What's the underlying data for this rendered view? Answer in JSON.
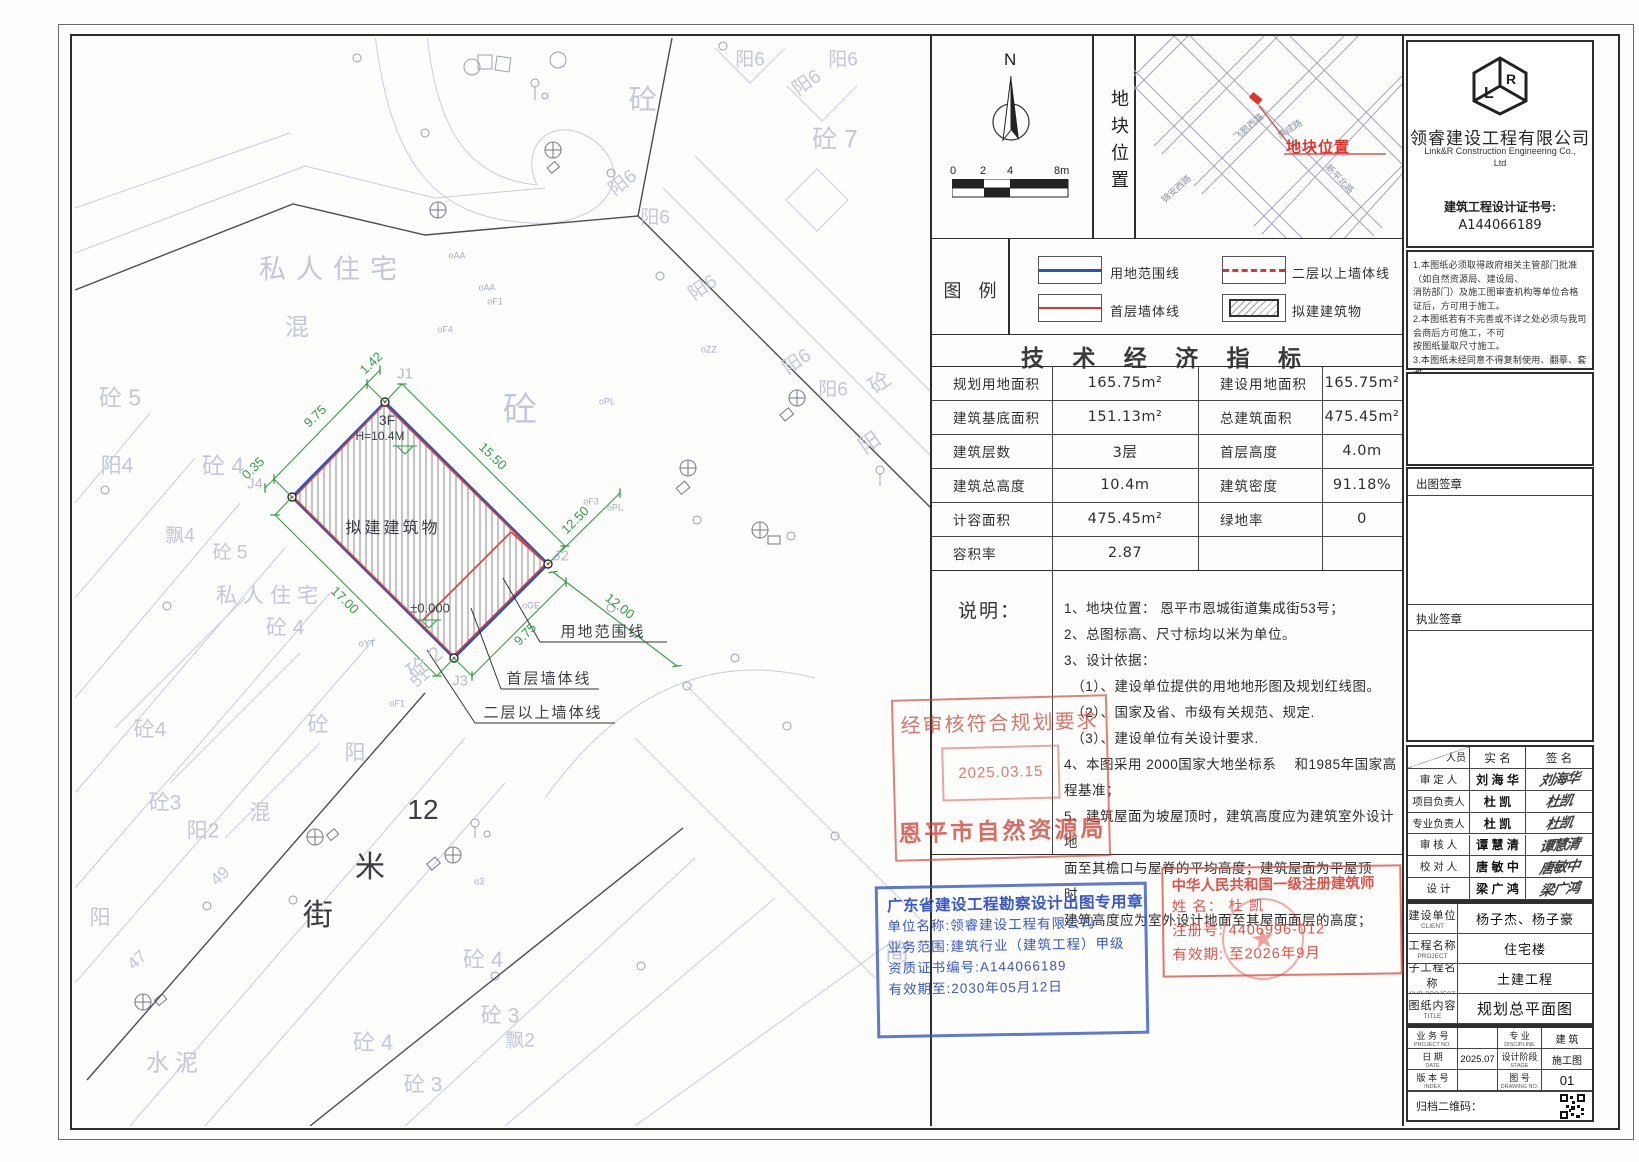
{
  "compass": {
    "north": "N",
    "scale_ticks": [
      "0",
      "2",
      "4",
      "8m"
    ]
  },
  "location_strip": "地块位置",
  "map": {
    "marker_label": "地块位置",
    "streets": [
      "飞鹅西路",
      "集成路",
      "新平北路",
      "锦安西路"
    ]
  },
  "legend": {
    "title": "图  例",
    "items": [
      "用地范围线",
      "二层以上墙体线",
      "首层墙体线",
      "拟建建筑物"
    ]
  },
  "tech": {
    "title": "技 术 经 济 指 标",
    "rows": [
      [
        "规划用地面积",
        "165.75m²",
        "建设用地面积",
        "165.75m²"
      ],
      [
        "建筑基底面积",
        "151.13m²",
        "总建筑面积",
        "475.45m²"
      ],
      [
        "建筑层数",
        "3层",
        "首层高度",
        "4.0m"
      ],
      [
        "建筑总高度",
        "10.4m",
        "建筑密度",
        "91.18%"
      ],
      [
        "计容面积",
        "475.45m²",
        "绿地率",
        "0"
      ],
      [
        "容积率",
        "2.87",
        "",
        ""
      ]
    ]
  },
  "notes": {
    "label": "说明：",
    "lines": [
      "1、地块位置：  恩平市恩城街道集成街53号；",
      "2、总图标高、尺寸标均以米为单位。",
      "3、设计依据：",
      "　（1）、建设单位提供的用地地形图及规划红线图。",
      "　（2）、国家及省、市级有关规范、规定.",
      "　（3）、建设单位有关设计要求.",
      "4、本图采用 2000国家大地坐标系　 和1985年国家高程基准；",
      "5、建筑屋面为坡屋顶时，建筑高度应为建筑室外设计地",
      "面至其檐口与屋脊的平均高度；建筑屋面为平屋顶时，",
      "建筑高度应为室外设计地面至其屋面面层的高度；"
    ]
  },
  "company": {
    "name_cn": "领睿建设工程有限公司",
    "name_en": "Link&R Construction Engineering Co.,",
    "name_en2": "Ltd",
    "cert_label": "建筑工程设计证书号:",
    "cert_no": "A144066189",
    "notes": [
      "1.本图纸必须取得政府相关主管部门批准（如自然资源局、建设局、",
      "消防部门）及施工图审查机构等单位合格证后，方可用于施工。",
      "2.本图纸若有不完善或不详之处必须与我司会商后方可施工，不可",
      "按图纸量取尺寸施工。",
      "3.本图纸未经同意不得复制使用、翻摹、套改。",
      "4.本图纸须加盖出图签章、执业签章及二维码,否则一律无效。"
    ]
  },
  "sign_boxes": {
    "chutu": "出图签章",
    "zhiye": "执业签章"
  },
  "personnel": {
    "header": [
      "人员",
      "实  名",
      "签  名"
    ],
    "rows": [
      [
        "审 定 人",
        "刘 海 华"
      ],
      [
        "项目负责人",
        "杜  凯"
      ],
      [
        "专业负责人",
        "杜  凯"
      ],
      [
        "审 核 人",
        "谭 慧 清"
      ],
      [
        "校 对 人",
        "唐 敏 中"
      ],
      [
        "设    计",
        "梁 广 鸿"
      ]
    ]
  },
  "project": {
    "rows": [
      {
        "cn": "建设单位",
        "en": "CLIENT",
        "v": "杨子杰、杨子豪"
      },
      {
        "cn": "工程名称",
        "en": "PROJECT",
        "v": "住宅楼"
      },
      {
        "cn": "子工程名称",
        "en": "SUB-PROJECT",
        "v": "土建工程"
      },
      {
        "cn": "图纸内容",
        "en": "TITLE",
        "v": "规划总平面图"
      }
    ]
  },
  "titleblock": {
    "cells": [
      {
        "cn": "业 务 号",
        "en": "PROJECT NO.",
        "v": ""
      },
      {
        "cn": "专  业",
        "en": "DISCIPLINE",
        "v": "建 筑"
      },
      {
        "cn": "日  期",
        "en": "DATE",
        "v": "2025.07"
      },
      {
        "cn": "设计阶段",
        "en": "STAGE",
        "v": "施工图"
      },
      {
        "cn": "版 本 号",
        "en": "INDEX",
        "v": ""
      },
      {
        "cn": "图  号",
        "en": "DRAWING NO.",
        "v": "01"
      }
    ],
    "qr_label": "归档二维码："
  },
  "stamps": {
    "planning": {
      "line1": "经审核符合规划要求",
      "date": "2025.03.15",
      "agency": "恩平市自然资源局"
    },
    "blue": {
      "title": "广东省建设工程勘察设计出图专用章",
      "l1": "单位名称:领睿建设工程有限公司",
      "l2": "业务范围:建筑行业（建筑工程）甲级",
      "l3": "资质证书编号:A144066189",
      "l4": "有效期至:2030年05月12日"
    },
    "architect": {
      "title": "中华人民共和国一级注册建筑师",
      "name": "姓  名：    杜  凯",
      "reg": "注册号: 4406996-012",
      "valid": "有效期: 至2026年9月",
      "seal_star": "★"
    }
  },
  "drawing": {
    "labels": [
      {
        "t": "私人住宅",
        "x": 258,
        "y": 232,
        "s": 27,
        "r": 0,
        "c": "f",
        "ls": 10
      },
      {
        "t": "混",
        "x": 222,
        "y": 290,
        "s": 24,
        "r": 0,
        "c": "f"
      },
      {
        "t": "砼 5",
        "x": 45,
        "y": 360,
        "s": 23,
        "r": 0,
        "c": "f"
      },
      {
        "t": "阳4",
        "x": 42,
        "y": 428,
        "s": 21,
        "r": 0,
        "c": "f"
      },
      {
        "t": "砼 4",
        "x": 148,
        "y": 428,
        "s": 23,
        "r": 0,
        "c": "f"
      },
      {
        "t": "飘4",
        "x": 105,
        "y": 498,
        "s": 19,
        "r": 0,
        "c": "f"
      },
      {
        "t": "砼 5",
        "x": 155,
        "y": 515,
        "s": 19,
        "r": 0,
        "c": "f"
      },
      {
        "t": "私人住宅",
        "x": 195,
        "y": 558,
        "s": 21,
        "r": 0,
        "c": "f",
        "ls": 6
      },
      {
        "t": "砼 4",
        "x": 210,
        "y": 590,
        "s": 21,
        "r": 0,
        "c": "f"
      },
      {
        "t": "砼 2",
        "x": 350,
        "y": 625,
        "s": 21,
        "r": -38,
        "c": "f"
      },
      {
        "t": "砼",
        "x": 445,
        "y": 372,
        "s": 34,
        "r": 0,
        "c": "f"
      },
      {
        "t": "砼",
        "x": 568,
        "y": 62,
        "s": 28,
        "r": 0,
        "c": "f"
      },
      {
        "t": "砼 7",
        "x": 760,
        "y": 102,
        "s": 25,
        "r": 0,
        "c": "f"
      },
      {
        "t": "阳6",
        "x": 675,
        "y": 22,
        "s": 19,
        "r": 0,
        "c": "f"
      },
      {
        "t": "阳6",
        "x": 732,
        "y": 45,
        "s": 19,
        "r": -35,
        "c": "f"
      },
      {
        "t": "阳6",
        "x": 768,
        "y": 22,
        "s": 19,
        "r": 0,
        "c": "f"
      },
      {
        "t": "阳6",
        "x": 548,
        "y": 145,
        "s": 19,
        "r": -38,
        "c": "f"
      },
      {
        "t": "阳6",
        "x": 580,
        "y": 180,
        "s": 19,
        "r": 0,
        "c": "f"
      },
      {
        "t": "阳6",
        "x": 628,
        "y": 250,
        "s": 19,
        "r": -35,
        "c": "f"
      },
      {
        "t": "阳6",
        "x": 722,
        "y": 324,
        "s": 19,
        "r": -35,
        "c": "f"
      },
      {
        "t": "阳6",
        "x": 758,
        "y": 352,
        "s": 19,
        "r": 0,
        "c": "f"
      },
      {
        "t": "砼",
        "x": 805,
        "y": 345,
        "s": 21,
        "r": -35,
        "c": "f"
      },
      {
        "t": "阳",
        "x": 795,
        "y": 405,
        "s": 21,
        "r": -35,
        "c": "f"
      },
      {
        "t": "J1",
        "x": 330,
        "y": 336,
        "s": 15,
        "r": 0,
        "c": "f2"
      },
      {
        "t": "J4",
        "x": 180,
        "y": 446,
        "s": 15,
        "r": 0,
        "c": "f2"
      },
      {
        "t": "J2",
        "x": 486,
        "y": 518,
        "s": 15,
        "r": 0,
        "c": "f2"
      },
      {
        "t": "J3",
        "x": 385,
        "y": 643,
        "s": 15,
        "r": 0,
        "c": "f2"
      },
      {
        "t": "砼4",
        "x": 75,
        "y": 692,
        "s": 21,
        "r": 0,
        "c": "f"
      },
      {
        "t": "砼3",
        "x": 90,
        "y": 765,
        "s": 21,
        "r": 0,
        "c": "f"
      },
      {
        "t": "阳2",
        "x": 128,
        "y": 793,
        "s": 21,
        "r": 0,
        "c": "f"
      },
      {
        "t": "混",
        "x": 185,
        "y": 775,
        "s": 21,
        "r": 0,
        "c": "f"
      },
      {
        "t": "砼",
        "x": 243,
        "y": 687,
        "s": 21,
        "r": 0,
        "c": "f"
      },
      {
        "t": "阳",
        "x": 280,
        "y": 715,
        "s": 21,
        "r": 0,
        "c": "f"
      },
      {
        "t": "阳",
        "x": 25,
        "y": 880,
        "s": 21,
        "r": 0,
        "c": "f"
      },
      {
        "t": "47",
        "x": 62,
        "y": 922,
        "s": 17,
        "r": -42,
        "c": "f"
      },
      {
        "t": "49",
        "x": 145,
        "y": 838,
        "s": 17,
        "r": -42,
        "c": "f"
      },
      {
        "t": "51",
        "x": 345,
        "y": 640,
        "s": 17,
        "r": -42,
        "c": "f"
      },
      {
        "t": "砼 4",
        "x": 408,
        "y": 922,
        "s": 22,
        "r": 0,
        "c": "f"
      },
      {
        "t": "砼 3",
        "x": 425,
        "y": 978,
        "s": 21,
        "r": 0,
        "c": "f"
      },
      {
        "t": "飘2",
        "x": 445,
        "y": 1003,
        "s": 19,
        "r": 0,
        "c": "f"
      },
      {
        "t": "砼 4",
        "x": 298,
        "y": 1005,
        "s": 22,
        "r": 0,
        "c": "f"
      },
      {
        "t": "砼 3",
        "x": 348,
        "y": 1047,
        "s": 21,
        "r": 0,
        "c": "f"
      },
      {
        "t": "水泥",
        "x": 100,
        "y": 1025,
        "s": 23,
        "r": 0,
        "c": "f",
        "ls": 6
      },
      {
        "t": "简",
        "x": 822,
        "y": 915,
        "s": 24,
        "r": 0,
        "c": "f"
      },
      {
        "t": "12",
        "x": 348,
        "y": 772,
        "s": 28,
        "r": 0,
        "c": "d"
      },
      {
        "t": "米",
        "x": 295,
        "y": 830,
        "s": 30,
        "r": 0,
        "c": "d"
      },
      {
        "t": "街",
        "x": 243,
        "y": 878,
        "s": 30,
        "r": 0,
        "c": "d"
      },
      {
        "t": "3F",
        "x": 312,
        "y": 382,
        "s": 14,
        "r": 0,
        "c": "k"
      },
      {
        "t": "H=10.4M",
        "x": 305,
        "y": 398,
        "s": 12,
        "r": 0,
        "c": "k"
      },
      {
        "t": "拟建建筑物",
        "x": 318,
        "y": 491,
        "s": 16,
        "r": 0,
        "c": "k",
        "ls": 3
      },
      {
        "t": "±0.000",
        "x": 355,
        "y": 570,
        "s": 13,
        "r": 0,
        "c": "k"
      },
      {
        "t": "用地范围线",
        "x": 528,
        "y": 594,
        "s": 15,
        "r": 0,
        "c": "k",
        "ls": 2
      },
      {
        "t": "首层墙体线",
        "x": 474,
        "y": 641,
        "s": 15,
        "r": 0,
        "c": "k",
        "ls": 2
      },
      {
        "t": "二层以上墙体线",
        "x": 468,
        "y": 675,
        "s": 15,
        "r": 0,
        "c": "k",
        "ls": 2
      },
      {
        "t": "9.75",
        "x": 240,
        "y": 378,
        "s": 13,
        "r": -44,
        "c": "g"
      },
      {
        "t": "1.42",
        "x": 296,
        "y": 325,
        "s": 13,
        "r": -44,
        "c": "g"
      },
      {
        "t": "0.35",
        "x": 178,
        "y": 430,
        "s": 13,
        "r": -44,
        "c": "g"
      },
      {
        "t": "15.50",
        "x": 418,
        "y": 418,
        "s": 13,
        "r": 44,
        "c": "g"
      },
      {
        "t": "12.50",
        "x": 500,
        "y": 482,
        "s": 13,
        "r": -45,
        "c": "g"
      },
      {
        "t": "17.00",
        "x": 270,
        "y": 562,
        "s": 13,
        "r": 44,
        "c": "g"
      },
      {
        "t": "9.75",
        "x": 450,
        "y": 596,
        "s": 13,
        "r": -45,
        "c": "g"
      },
      {
        "t": "12.00",
        "x": 545,
        "y": 568,
        "s": 13,
        "r": 38,
        "c": "g"
      },
      {
        "t": "oAA",
        "x": 382,
        "y": 218,
        "s": 9,
        "r": 0,
        "c": "f3"
      },
      {
        "t": "oAA",
        "x": 412,
        "y": 250,
        "s": 9,
        "r": 0,
        "c": "f3"
      },
      {
        "t": "oF1",
        "x": 420,
        "y": 264,
        "s": 9,
        "r": 0,
        "c": "f3"
      },
      {
        "t": "oF4",
        "x": 370,
        "y": 292,
        "s": 9,
        "r": 0,
        "c": "f3"
      },
      {
        "t": "oZZ",
        "x": 634,
        "y": 312,
        "s": 9,
        "r": 0,
        "c": "f3"
      },
      {
        "t": "oPL",
        "x": 532,
        "y": 364,
        "s": 9,
        "r": 0,
        "c": "f3"
      },
      {
        "t": "oF3",
        "x": 516,
        "y": 464,
        "s": 9,
        "r": 0,
        "c": "f3"
      },
      {
        "t": "oPL",
        "x": 540,
        "y": 470,
        "s": 9,
        "r": 0,
        "c": "f3"
      },
      {
        "t": "oYT",
        "x": 292,
        "y": 606,
        "s": 9,
        "r": 0,
        "c": "f3"
      },
      {
        "t": "oGE",
        "x": 456,
        "y": 568,
        "s": 9,
        "r": 0,
        "c": "f3"
      },
      {
        "t": "o3",
        "x": 404,
        "y": 844,
        "s": 9,
        "r": 0,
        "c": "f3"
      },
      {
        "t": "oF1",
        "x": 322,
        "y": 666,
        "s": 9,
        "r": 0,
        "c": "f3"
      }
    ]
  }
}
